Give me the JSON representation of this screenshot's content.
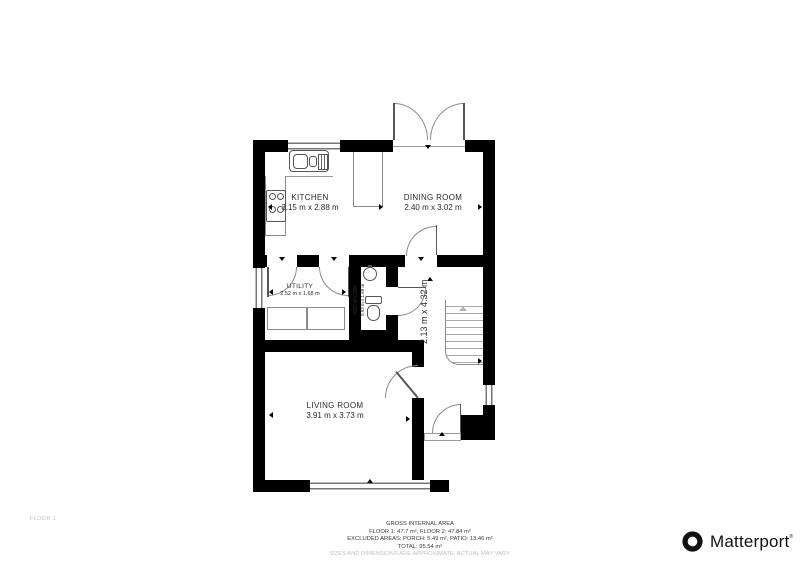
{
  "floorplan": {
    "rooms": [
      {
        "id": "kitchen",
        "name": "KITCHEN",
        "dims": "3.15 m x 2.88 m"
      },
      {
        "id": "dining",
        "name": "DINING ROOM",
        "dims": "2.40 m x 3.02 m"
      },
      {
        "id": "utility",
        "name": "UTILITY",
        "dims": "2.52 m x 1.68 m"
      },
      {
        "id": "bathroom",
        "name": "BATHROOM",
        "dims": "0.93 m x 1.68 m"
      },
      {
        "id": "hallway",
        "dims": "2.13 m x 4.32 m"
      },
      {
        "id": "living",
        "name": "LIVING ROOM",
        "dims": "3.91 m x 3.73 m"
      }
    ],
    "colors": {
      "wall": "#000000",
      "thin_line": "#8a8a8a",
      "label_text": "#2a2a2a",
      "muted_text": "#c0c0c0"
    }
  },
  "footer": {
    "floor_label": "FLOOR 1",
    "area_lines": [
      "GROSS INTERNAL AREA",
      "FLOOR 1: 47.7 m², FLOOR 2: 47.84 m²",
      "EXCLUDED AREAS; PORCH: 5.49 m², PATIO: 13.46 m²",
      "TOTAL: 95.54 m²"
    ],
    "disclaimer": "SIZES AND DIMENSIONS ARE APPROXIMATE, ACTUAL MAY VARY.",
    "brand": "Matterport"
  }
}
